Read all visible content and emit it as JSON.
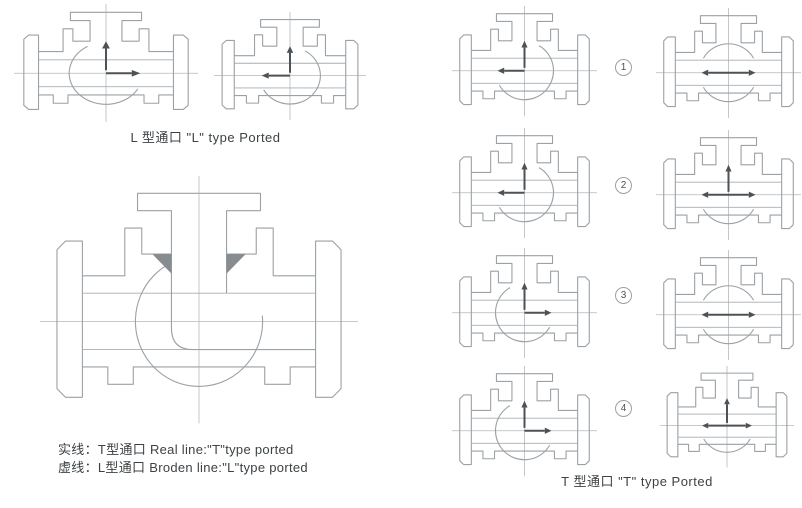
{
  "colors": {
    "outline": "#9ba1a5",
    "centerline": "#b4b9bc",
    "bore": "#a7adb0",
    "arrow": "#4d5256",
    "seat": "#868c90",
    "text": "#3d4245"
  },
  "captions": {
    "l_type": "L 型通口 \"L\" type Ported",
    "t_type": "T 型通口 \"T\" type Ported",
    "legend_line1": "实线：T型通口 Real line:\"T\"type ported",
    "legend_line2": "虚线：L型通口 Broden line:\"L\"type ported"
  },
  "markers": [
    {
      "label": "1"
    },
    {
      "label": "2"
    },
    {
      "label": "3"
    },
    {
      "label": "4"
    }
  ],
  "valves": {
    "l_type_examples": [
      {
        "id": "l-ported-left-view",
        "flow": "up-right"
      },
      {
        "id": "l-ported-right-view",
        "flow": "up-left"
      }
    ],
    "cutaway": {
      "id": "sectional-view",
      "flow": "cutaway",
      "solid_line_meaning": "T型通口 T type ported",
      "broken_line_meaning": "L型通口 L type ported"
    },
    "t_type_positions": [
      {
        "position": "1",
        "left_flow": "up-left",
        "right_flow": "through"
      },
      {
        "position": "2",
        "left_flow": "up-left",
        "right_flow": "all"
      },
      {
        "position": "3",
        "left_flow": "up-right",
        "right_flow": "through"
      },
      {
        "position": "4",
        "left_flow": "up-right",
        "right_flow": "all"
      }
    ]
  }
}
